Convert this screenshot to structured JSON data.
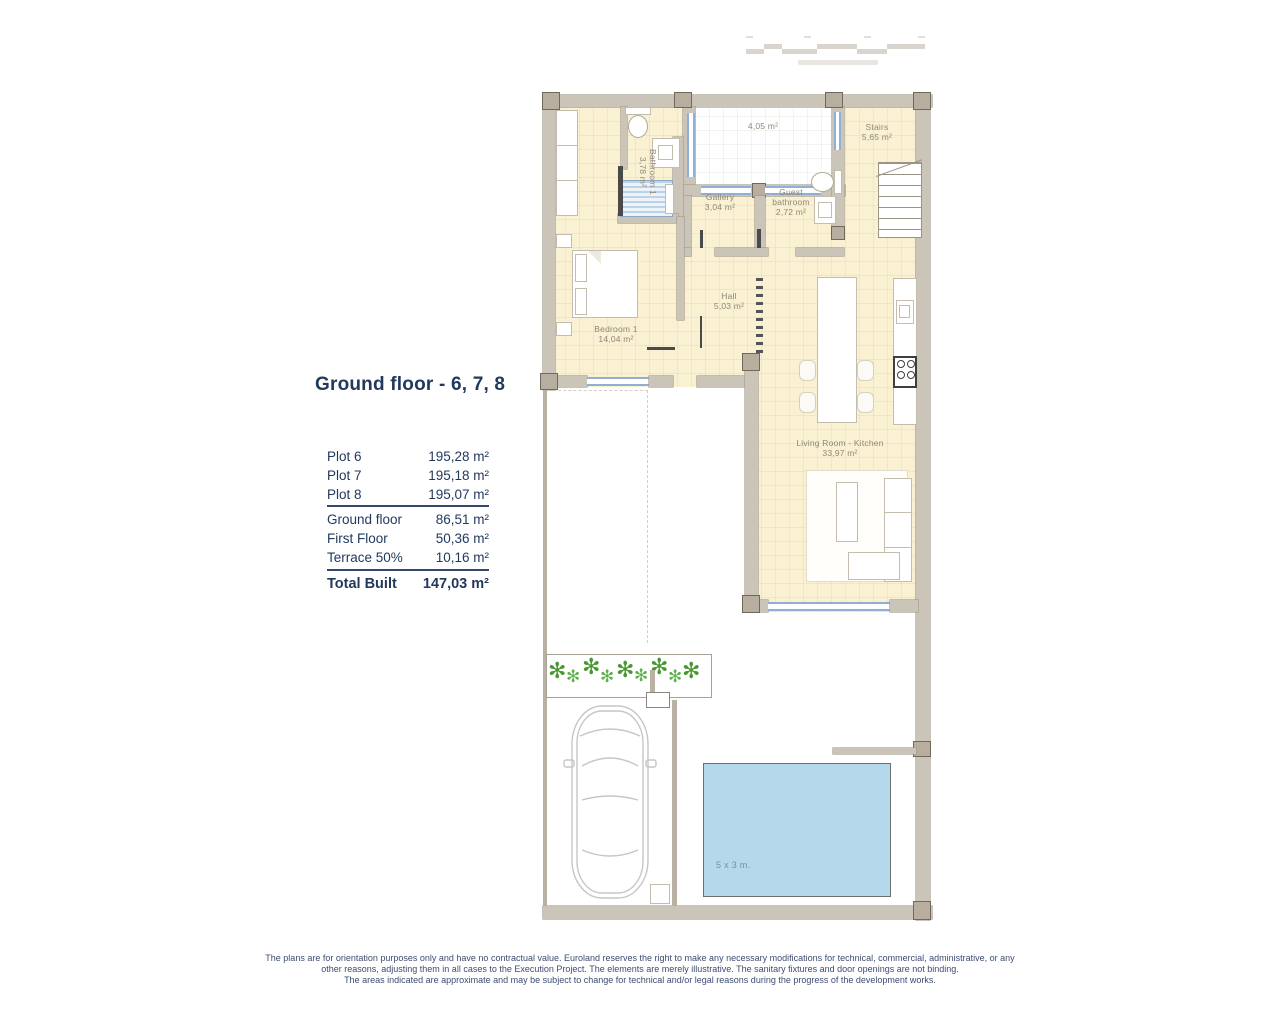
{
  "panel": {
    "title": "Ground floor - 6, 7, 8",
    "plots": [
      {
        "label": "Plot 6",
        "value": "195,28 m²"
      },
      {
        "label": "Plot 7",
        "value": "195,18 m²"
      },
      {
        "label": "Plot 8",
        "value": "195,07 m²"
      }
    ],
    "breakdown": [
      {
        "label": "Ground floor",
        "value": "86,51 m²"
      },
      {
        "label": "First Floor",
        "value": "50,36 m²"
      },
      {
        "label": "Terrace 50%",
        "value": "10,16 m²"
      }
    ],
    "total": {
      "label": "Total Built",
      "value": "147,03 m²"
    }
  },
  "plan": {
    "rooms": {
      "bathroom1": {
        "name": "Bathroom 1",
        "area": "3,78 m²"
      },
      "patio": {
        "area": "4,05 m²"
      },
      "stairs": {
        "name": "Stairs",
        "area": "5,65 m²"
      },
      "gallery": {
        "name": "Gallery",
        "area": "3,04 m²"
      },
      "guest_bathroom": {
        "name": "Guest bathroom",
        "area": "2,72 m²"
      },
      "hall": {
        "name": "Hall",
        "area": "5,03 m²"
      },
      "bedroom1": {
        "name": "Bedroom 1",
        "area": "14,04 m²"
      },
      "living_kitchen": {
        "name": "Living Room - Kitchen",
        "area": "33,97 m²"
      },
      "pool": {
        "label": "5 x 3 m."
      }
    }
  },
  "footer": {
    "disclaimer_lines": [
      "The plans are for orientation purposes only and have no contractual value. Euroland reserves the right to make any necessary modifications for technical, commercial, administrative, or any",
      "other reasons, adjusting them in all cases to the Execution Project. The elements are merely illustrative. The sanitary fixtures and door openings are not binding.",
      "The areas indicated are approximate and may be subject to change for technical and/or legal reasons during the progress of the development works."
    ]
  },
  "colors": {
    "accent_navy": "#22395e",
    "floor_cream": "#faf0d2",
    "wall_gray": "#cbc4b8",
    "window_blue": "#8fb0d4",
    "pool_blue": "#b5d9eb",
    "plant_green": "#47982f"
  }
}
